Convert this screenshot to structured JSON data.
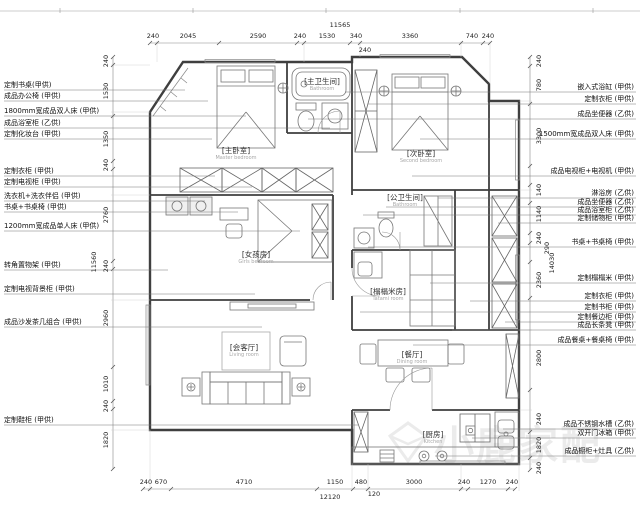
{
  "watermark": {
    "text": "小鹿家配"
  },
  "dims": {
    "top": {
      "total": "11565",
      "sub": "240",
      "segments": [
        "240",
        "2045",
        "2590",
        "240",
        "1530",
        "340",
        "3360",
        "740",
        "240"
      ]
    },
    "bottom": {
      "total": "12120",
      "sub": "120",
      "segments": [
        "240",
        "670",
        "4710",
        "1150",
        "480",
        "3000",
        "240",
        "1270",
        "240"
      ]
    },
    "left": {
      "total": "11560",
      "segments": [
        "240",
        "1530",
        "1350",
        "240",
        "2760",
        "240",
        "2960",
        "1010",
        "240",
        "1820"
      ]
    },
    "right": {
      "total": "14030",
      "segments": [
        "240",
        "780",
        "3300",
        "140",
        "1140",
        "240",
        "290",
        "2360",
        "2800",
        "240",
        "1820",
        "240"
      ]
    }
  },
  "labels_left": [
    {
      "text": "定制书桌(甲供)"
    },
    {
      "text": "成品办公椅 (甲供)"
    },
    {
      "text": "1800mm宽成品双人床 (甲供)"
    },
    {
      "text": "成品浴室柜 (乙供)"
    },
    {
      "text": "定制化妆台 (甲供)"
    },
    {
      "text": "定制衣柜 (甲供)"
    },
    {
      "text": "定制电视柜 (甲供)"
    },
    {
      "text": "洗衣机+洗衣伴侣 (甲供)"
    },
    {
      "text": "书桌+书桌椅 (甲供)"
    },
    {
      "text": "1200mm宽成品单人床 (甲供)"
    },
    {
      "text": "转角置物架 (甲供)"
    },
    {
      "text": "定制电视背景柜 (甲供)"
    },
    {
      "text": "成品沙发茶几组合 (甲供)"
    },
    {
      "text": "定制鞋柜 (甲供)"
    }
  ],
  "labels_right": [
    {
      "text": "嵌入式浴缸 (甲供)"
    },
    {
      "text": "定制衣柜 (甲供)"
    },
    {
      "text": "成品坐便器 (乙供)"
    },
    {
      "text": "1500mm宽成品双人床 (甲供)"
    },
    {
      "text": "成品电视柜+电视机 (甲供)"
    },
    {
      "text": "淋浴房 (乙供)"
    },
    {
      "text": "成品坐便器 (乙供)"
    },
    {
      "text": "成品浴室柜 (乙供)"
    },
    {
      "text": "定制储物柜 (甲供)"
    },
    {
      "text": "书桌+书桌椅 (甲供)"
    },
    {
      "text": "定制榻榻米 (甲供)"
    },
    {
      "text": "定制衣柜 (甲供)"
    },
    {
      "text": "定制书柜 (甲供)"
    },
    {
      "text": "定制餐边柜 (甲供)"
    },
    {
      "text": "成品长条凳 (甲供)"
    },
    {
      "text": "成品餐桌+餐桌椅 (甲供)"
    },
    {
      "text": "成品不锈钢水槽 (乙供)"
    },
    {
      "text": "双开门冰箱 (甲供)"
    },
    {
      "text": "成品橱柜+灶具 (乙供)"
    }
  ],
  "rooms": [
    {
      "zh": "[主卧室]",
      "en": "Master bedroom"
    },
    {
      "zh": "[次卧室]",
      "en": "Second bedroom"
    },
    {
      "zh": "[主卫生间]",
      "en": "Bathroom"
    },
    {
      "zh": "[公卫生间]",
      "en": "Bathroom"
    },
    {
      "zh": "[女孩房]",
      "en": "Girls bedroom"
    },
    {
      "zh": "[榻榻米房]",
      "en": "Tatami room"
    },
    {
      "zh": "[会客厅]",
      "en": "Living room"
    },
    {
      "zh": "[餐厅]",
      "en": "Dining room"
    },
    {
      "zh": "[厨房]",
      "en": "Kitchen"
    }
  ],
  "colors": {
    "line": "#3f3f3f",
    "dim": "#333333",
    "watermark": "#d8d8d8"
  }
}
